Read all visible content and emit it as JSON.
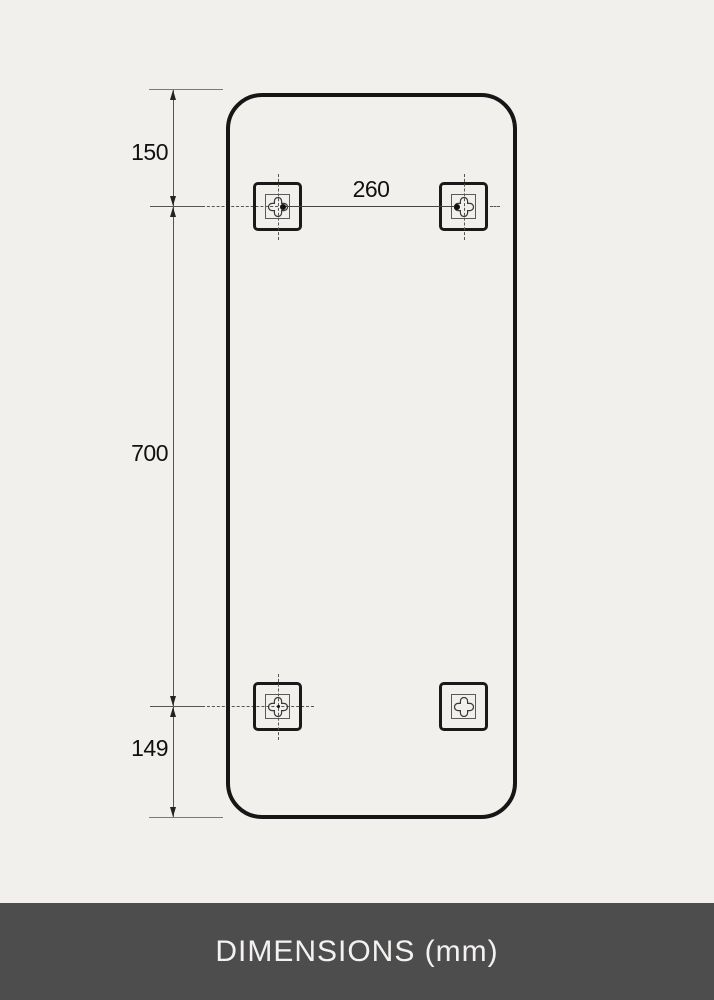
{
  "footer": {
    "label": "DIMENSIONS (mm)",
    "background": "#4e4d4d",
    "text_color": "#f3f2f0"
  },
  "diagram": {
    "type": "product-dimension-drawing",
    "subject": "rounded-rectangle mirror, rear view with four mounting brackets",
    "unit": "mm",
    "dimensions": {
      "top_edge_to_top_brackets": "150",
      "top_brackets_to_bottom_brackets": "700",
      "bottom_brackets_to_bottom_edge": "149",
      "bracket_horizontal_spacing": "260"
    },
    "brackets": [
      "top-left",
      "top-right",
      "bottom-left",
      "bottom-right"
    ],
    "icons": [
      "screw-slot-icon",
      "arrowhead-up-icon",
      "arrowhead-down-icon"
    ],
    "colors": {
      "background": "#f1f0ed",
      "outline": "#161616",
      "dimension_line": "#555555",
      "label_text": "#111111"
    }
  }
}
